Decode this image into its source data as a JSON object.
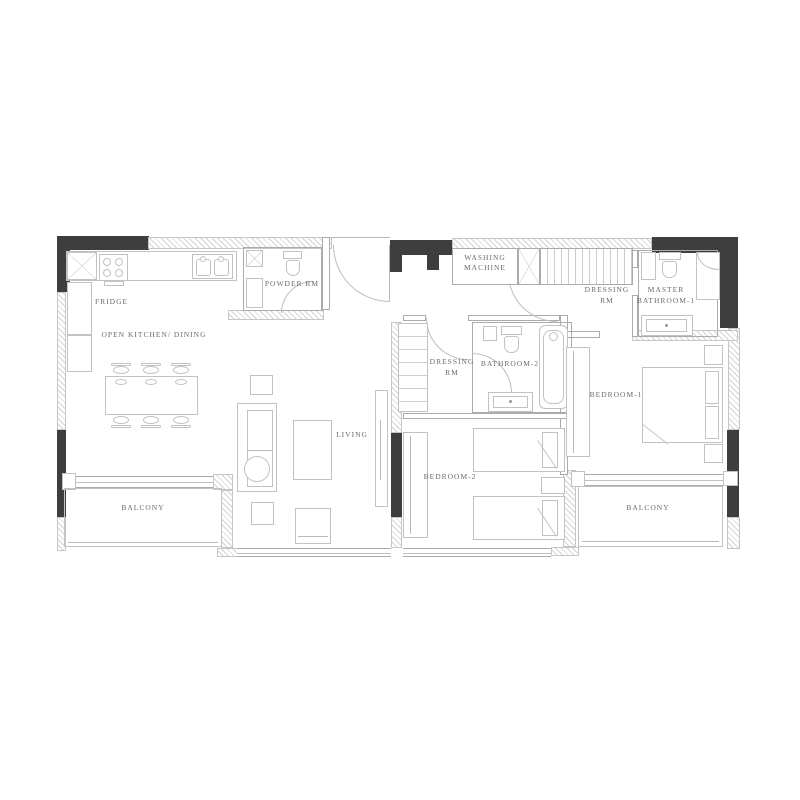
{
  "title": "Apartment floor plan",
  "colors": {
    "background": "#ffffff",
    "wall_dark": "#3e3e3e",
    "wall_line": "#ababab",
    "furniture_line": "#c2c2c2",
    "text": "#6b6b6b"
  },
  "rooms": {
    "open_kitchen_dining": {
      "label": "OPEN KITCHEN/ DINING"
    },
    "fridge": {
      "label": "FRIDGE"
    },
    "powder_room": {
      "label": "POWDER RM"
    },
    "washing_machine": {
      "line1": "WASHING",
      "line2": "MACHINE"
    },
    "dressing_room_master": {
      "line1": "DRESSING",
      "line2": "RM"
    },
    "master_bathroom": {
      "line1": "MASTER",
      "line2": "BATHROOM-1"
    },
    "dressing_room_2": {
      "line1": "DRESSING",
      "line2": "RM"
    },
    "bathroom_2": {
      "label": "BATHROOM-2"
    },
    "living": {
      "label": "LIVING"
    },
    "bedroom_1": {
      "label": "BEDROOM-1"
    },
    "bedroom_2": {
      "label": "BEDROOM-2"
    },
    "balcony_left": {
      "label": "BALCONY"
    },
    "balcony_right": {
      "label": "BALCONY"
    }
  }
}
